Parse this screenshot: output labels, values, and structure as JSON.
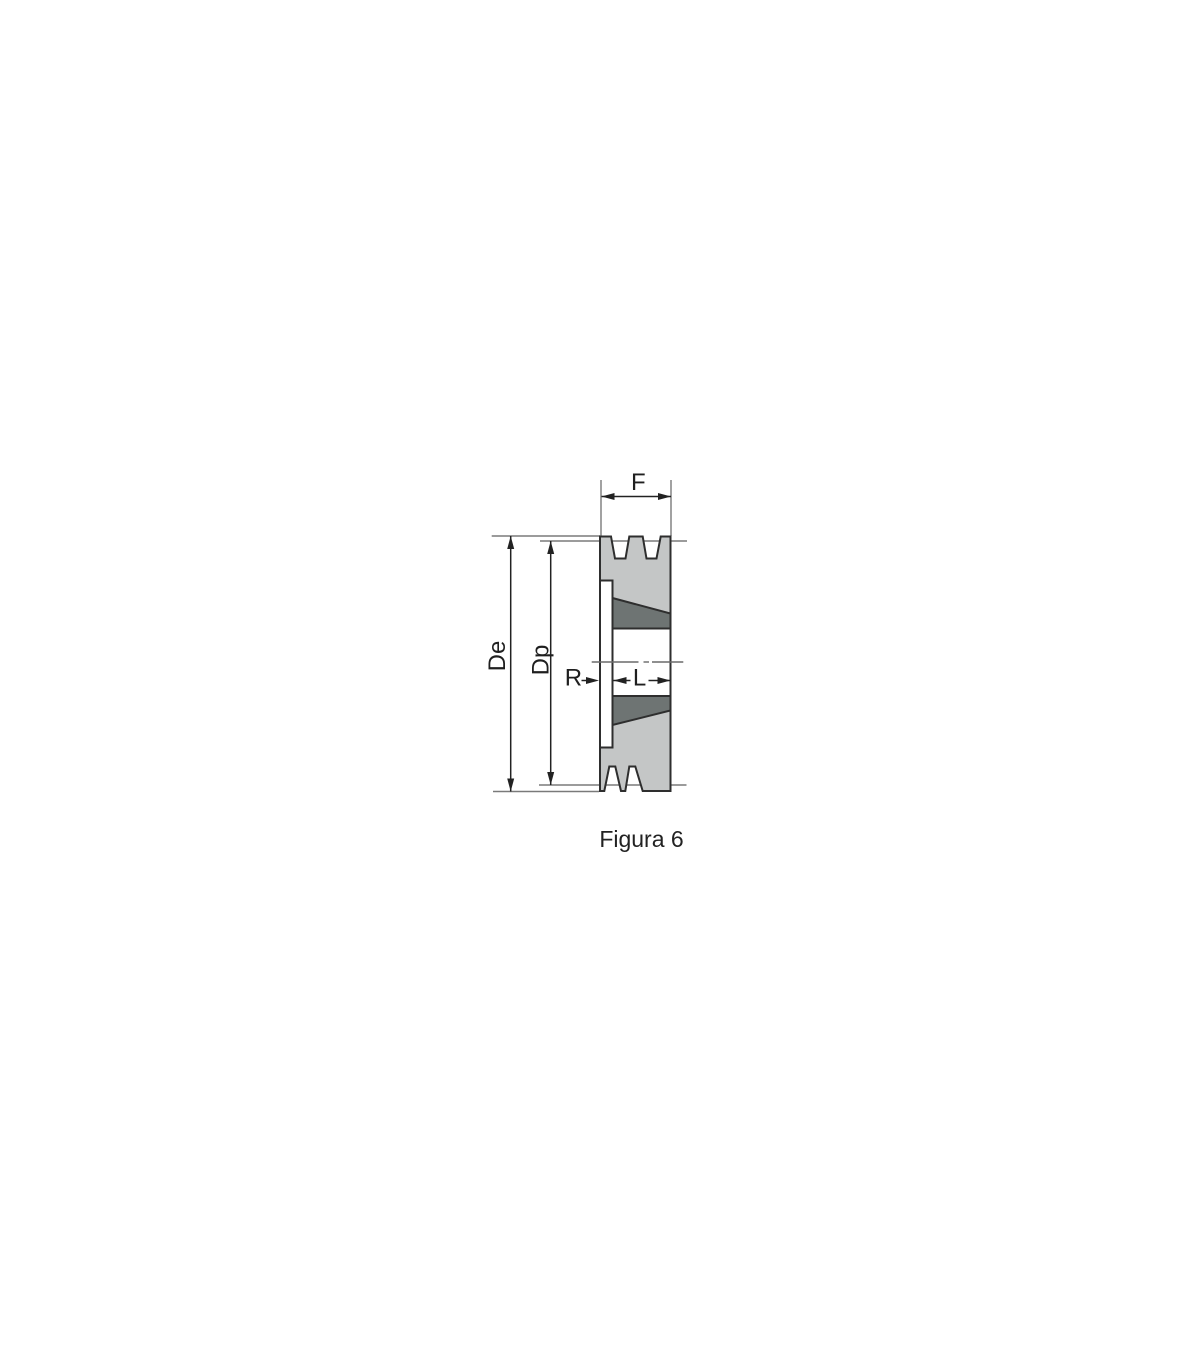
{
  "caption": "Figura 6",
  "labels": {
    "f": "F",
    "de": "De",
    "dp": "Dp",
    "r": "R",
    "l": "L"
  },
  "colors": {
    "background": "#ffffff",
    "body_fill": "#c4c6c6",
    "bushing_fill": "#6e7473",
    "bore_fill": "#ffffff",
    "flange_fill": "#ffffff",
    "outline": "#2e2e2e",
    "dimension_line": "#222222",
    "extension_line": "#7a7a7a",
    "centerline": "#6a6a6a",
    "text": "#1f1f1f"
  }
}
